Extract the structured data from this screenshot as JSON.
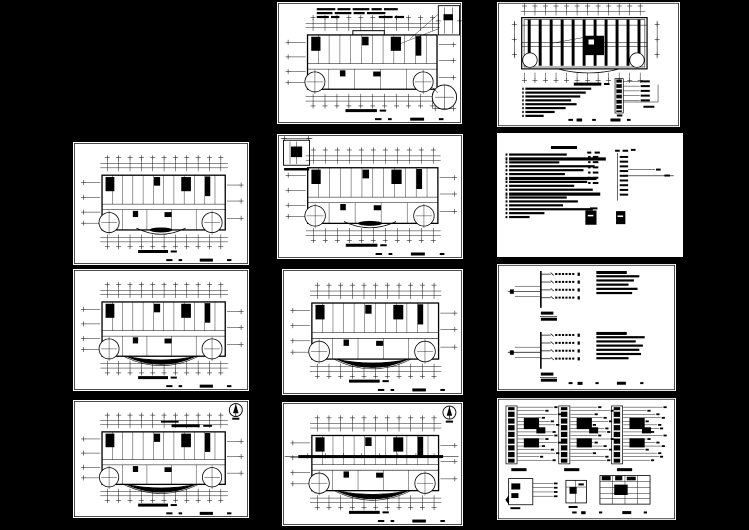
{
  "app": {
    "description": "cad-multi-sheet-drawing-preview"
  },
  "canvas": {
    "width": 749,
    "height": 530,
    "background": "#000000",
    "sheet_color": "#ffffff",
    "ink": "#000000"
  },
  "sheets": [
    {
      "id": "c1",
      "name": "first-floor-plan-sheet",
      "type": "floorplan",
      "x": 277,
      "y": 2,
      "w": 185,
      "h": 122,
      "variants": [
        "notes_top",
        "detail_top_right",
        "extra_circle",
        "top_bump"
      ]
    },
    {
      "id": "r1",
      "name": "roof-plan-sheet",
      "type": "roofplan",
      "x": 497,
      "y": 2,
      "w": 183,
      "h": 125,
      "notes_widths": [
        0.36,
        0.33,
        0.3,
        0.25,
        0.28,
        0.22,
        0.16,
        0.1
      ]
    },
    {
      "id": "l2",
      "name": "floor-plan-sheet-2",
      "type": "floorplan",
      "x": 73,
      "y": 142,
      "w": 176,
      "h": 123,
      "variants": [
        "small_arc"
      ]
    },
    {
      "id": "c2",
      "name": "floor-plan-sheet-3",
      "type": "floorplan",
      "x": 277,
      "y": 134,
      "w": 186,
      "h": 125,
      "variants": [
        "small_arc",
        "detail_top_left"
      ]
    },
    {
      "id": "r2",
      "name": "design-notes-sheet",
      "type": "notes",
      "x": 497,
      "y": 133,
      "w": 186,
      "h": 124,
      "left_line_widths": [
        0.31,
        0.52,
        0.27,
        0.46,
        0.4,
        0.3,
        0.47,
        0.42,
        0.35,
        0.45,
        0.49,
        0.31,
        0.37,
        0.29,
        0.45,
        0.19,
        0.11
      ],
      "legend_rows": 6
    },
    {
      "id": "l3",
      "name": "floor-plan-sheet-4",
      "type": "floorplan",
      "x": 73,
      "y": 269,
      "w": 176,
      "h": 122,
      "variants": [
        "front_arc"
      ]
    },
    {
      "id": "c3",
      "name": "floor-plan-sheet-5",
      "type": "floorplan",
      "x": 282,
      "y": 269,
      "w": 181,
      "h": 126,
      "variants": [
        "front_arc"
      ]
    },
    {
      "id": "r3",
      "name": "power-distribution-system-sheet",
      "type": "systems",
      "x": 497,
      "y": 264,
      "w": 179,
      "h": 127,
      "groups": [
        0.045,
        0.525
      ],
      "branches": 4,
      "text_blocks": [
        [
          0.17,
          0.24,
          0.21,
          0.18,
          0.23,
          0.2
        ],
        [
          0.17,
          0.27,
          0.22,
          0.26,
          0.24,
          0.25,
          0.18
        ]
      ]
    },
    {
      "id": "l4",
      "name": "floor-plan-sheet-6",
      "type": "floorplan",
      "x": 73,
      "y": 400,
      "w": 176,
      "h": 118,
      "variants": [
        "front_arc",
        "north_arrow",
        "notes_mid"
      ]
    },
    {
      "id": "c4",
      "name": "floor-plan-sheet-7",
      "type": "floorplan",
      "x": 282,
      "y": 402,
      "w": 181,
      "h": 124,
      "variants": [
        "front_arc",
        "north_arrow",
        "dark_corridor"
      ]
    },
    {
      "id": "r4",
      "name": "panel-schedule-sheet",
      "type": "panels",
      "x": 497,
      "y": 398,
      "w": 179,
      "h": 122,
      "panel_origins": [
        0.05,
        0.345,
        0.64
      ],
      "row_lengths": [
        0.2,
        0.15,
        0.22,
        0.13,
        0.18,
        0.21,
        0.12,
        0.19
      ]
    }
  ]
}
